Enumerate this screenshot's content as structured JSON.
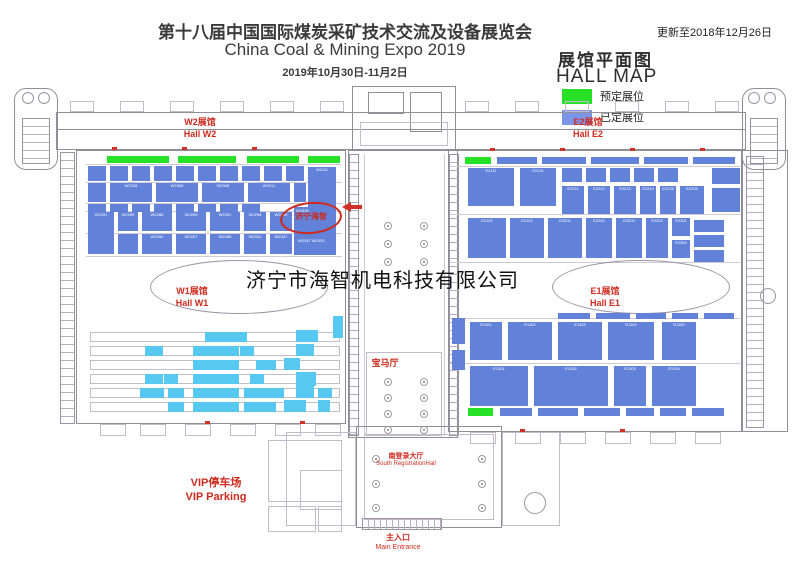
{
  "header": {
    "title_cn": "第十八届中国国际煤炭采矿技术交流及设备展览会",
    "title_en": "China Coal & Mining Expo 2019",
    "dates": "2019年10月30日-11月2日",
    "updated": "更新至2018年12月26日"
  },
  "legend": {
    "title_cn": "展馆平面图",
    "title_en": "HALL MAP",
    "items": [
      {
        "label": "预定展位",
        "color": "#27e127"
      },
      {
        "label": "已定展位",
        "color": "#7d95e8"
      }
    ]
  },
  "colors": {
    "booked": "#6282da",
    "light": "#57c9f1",
    "reserved": "#27e127"
  },
  "halls": {
    "w2": {
      "cn": "W2展馆",
      "en": "Hall W2"
    },
    "e2": {
      "cn": "E2展馆",
      "en": "Hall E2"
    },
    "w1": {
      "cn": "W1展馆",
      "en": "Hall W1"
    },
    "e1": {
      "cn": "E1展馆",
      "en": "Hall E1"
    }
  },
  "labels": {
    "bmw_hall": "宝马厅",
    "south_hall_cn": "南登录大厅",
    "south_hall_en": "South RegistrationHall",
    "vip_cn": "VIP停车场",
    "vip_en": "VIP Parking",
    "entrance_cn": "主入口",
    "entrance_en": "Main Entrance",
    "watermark": "济宁市海智机电科技有限公司"
  },
  "highlight": {
    "company": "济宁海智",
    "booth_top": "W2335",
    "booths_bottom": "W2337  W2333"
  },
  "floorplan": {
    "booths": [
      [
        107,
        156,
        62,
        7,
        "g"
      ],
      [
        178,
        156,
        58,
        7,
        "g"
      ],
      [
        247,
        156,
        52,
        7,
        "g"
      ],
      [
        308,
        156,
        32,
        7,
        "g"
      ],
      [
        465,
        157,
        26,
        7,
        "g"
      ],
      [
        468,
        408,
        25,
        8,
        "g"
      ],
      [
        497,
        157,
        40,
        7,
        "b"
      ],
      [
        542,
        157,
        44,
        7,
        "b"
      ],
      [
        591,
        157,
        48,
        7,
        "b"
      ],
      [
        644,
        157,
        44,
        7,
        "b"
      ],
      [
        693,
        157,
        42,
        7,
        "b"
      ],
      [
        558,
        313,
        32,
        6,
        "b"
      ],
      [
        596,
        313,
        34,
        6,
        "b"
      ],
      [
        636,
        313,
        30,
        6,
        "b"
      ],
      [
        672,
        313,
        26,
        6,
        "b"
      ],
      [
        704,
        313,
        30,
        6,
        "b"
      ],
      [
        500,
        408,
        32,
        8,
        "b"
      ],
      [
        538,
        408,
        40,
        8,
        "b"
      ],
      [
        584,
        408,
        36,
        8,
        "b"
      ],
      [
        626,
        408,
        28,
        8,
        "b"
      ],
      [
        660,
        408,
        26,
        8,
        "b"
      ],
      [
        692,
        408,
        32,
        8,
        "b"
      ],
      [
        88,
        166,
        18,
        15,
        "b"
      ],
      [
        110,
        166,
        18,
        15,
        "b"
      ],
      [
        132,
        166,
        18,
        15,
        "b"
      ],
      [
        154,
        166,
        18,
        15,
        "b"
      ],
      [
        176,
        166,
        18,
        15,
        "b"
      ],
      [
        198,
        166,
        18,
        15,
        "b"
      ],
      [
        220,
        166,
        18,
        15,
        "b"
      ],
      [
        242,
        166,
        18,
        15,
        "b"
      ],
      [
        264,
        166,
        18,
        15,
        "b"
      ],
      [
        286,
        166,
        18,
        15,
        "b"
      ],
      [
        308,
        167,
        28,
        42,
        "b",
        "W2111"
      ],
      [
        88,
        183,
        18,
        19,
        "b"
      ],
      [
        110,
        183,
        42,
        19,
        "b",
        "W2305"
      ],
      [
        156,
        183,
        42,
        19,
        "b",
        "W2306"
      ],
      [
        202,
        183,
        42,
        19,
        "b",
        "W2308"
      ],
      [
        248,
        183,
        42,
        19,
        "b",
        "W2311"
      ],
      [
        294,
        183,
        12,
        19,
        "b"
      ],
      [
        88,
        204,
        18,
        8,
        "b"
      ],
      [
        110,
        204,
        18,
        8,
        "b"
      ],
      [
        132,
        204,
        18,
        8,
        "b"
      ],
      [
        154,
        204,
        18,
        8,
        "b"
      ],
      [
        176,
        204,
        18,
        8,
        "b"
      ],
      [
        198,
        204,
        18,
        8,
        "b"
      ],
      [
        220,
        204,
        18,
        8,
        "b"
      ],
      [
        242,
        204,
        18,
        8,
        "b"
      ],
      [
        88,
        212,
        26,
        42,
        "b",
        "W2201"
      ],
      [
        118,
        212,
        20,
        19,
        "b",
        "W2289"
      ],
      [
        142,
        212,
        30,
        19,
        "b",
        "W2286"
      ],
      [
        176,
        212,
        30,
        19,
        "b",
        "W2283"
      ],
      [
        210,
        212,
        30,
        19,
        "b",
        "W2301"
      ],
      [
        244,
        212,
        22,
        19,
        "b",
        "W2298"
      ],
      [
        270,
        212,
        22,
        19,
        "b",
        "W2295"
      ],
      [
        294,
        207,
        42,
        48,
        "b"
      ],
      [
        118,
        234,
        20,
        20,
        "b"
      ],
      [
        142,
        234,
        30,
        20,
        "b",
        "W2284"
      ],
      [
        176,
        234,
        30,
        20,
        "b",
        "W2287"
      ],
      [
        210,
        234,
        30,
        20,
        "b",
        "W2288"
      ],
      [
        244,
        234,
        22,
        20,
        "b",
        "W2304"
      ],
      [
        270,
        234,
        22,
        20,
        "b",
        "W2307"
      ],
      [
        468,
        168,
        46,
        38,
        "b",
        "E2111"
      ],
      [
        520,
        168,
        36,
        38,
        "b",
        "E2131"
      ],
      [
        562,
        168,
        20,
        14,
        "b"
      ],
      [
        586,
        168,
        20,
        14,
        "b"
      ],
      [
        610,
        168,
        20,
        14,
        "b"
      ],
      [
        634,
        168,
        20,
        14,
        "b"
      ],
      [
        658,
        168,
        20,
        14,
        "b"
      ],
      [
        712,
        168,
        28,
        16,
        "b"
      ],
      [
        712,
        188,
        28,
        24,
        "b"
      ],
      [
        562,
        186,
        22,
        28,
        "b",
        "E2211"
      ],
      [
        588,
        186,
        22,
        28,
        "b",
        "E2212"
      ],
      [
        614,
        186,
        22,
        28,
        "b",
        "E2213"
      ],
      [
        640,
        186,
        16,
        28,
        "b",
        "E2214"
      ],
      [
        660,
        186,
        16,
        28,
        "b",
        "E2215"
      ],
      [
        680,
        186,
        24,
        28,
        "b",
        "E2209"
      ],
      [
        468,
        218,
        38,
        40,
        "b",
        "E2101"
      ],
      [
        510,
        218,
        34,
        40,
        "b",
        "E2102"
      ],
      [
        548,
        218,
        34,
        40,
        "b",
        "E2201"
      ],
      [
        586,
        218,
        26,
        40,
        "b",
        "E2202"
      ],
      [
        616,
        218,
        26,
        40,
        "b",
        "E2203"
      ],
      [
        646,
        218,
        22,
        40,
        "b",
        "E2204"
      ],
      [
        672,
        218,
        18,
        18,
        "b",
        "E2301"
      ],
      [
        672,
        240,
        18,
        18,
        "b",
        "E2302"
      ],
      [
        694,
        220,
        30,
        12,
        "b"
      ],
      [
        694,
        235,
        30,
        12,
        "b"
      ],
      [
        694,
        250,
        30,
        12,
        "b"
      ],
      [
        470,
        322,
        32,
        38,
        "b",
        "E1101"
      ],
      [
        508,
        322,
        44,
        38,
        "b",
        "E1102"
      ],
      [
        558,
        322,
        44,
        38,
        "b",
        "E1103"
      ],
      [
        608,
        322,
        46,
        38,
        "b",
        "E1104"
      ],
      [
        662,
        322,
        34,
        38,
        "b",
        "E1105"
      ],
      [
        470,
        366,
        58,
        40,
        "b",
        "E1301"
      ],
      [
        534,
        366,
        74,
        40,
        "b",
        "E1302"
      ],
      [
        614,
        366,
        32,
        40,
        "b",
        "E1303"
      ],
      [
        652,
        366,
        44,
        40,
        "b",
        "E1304"
      ],
      [
        452,
        318,
        13,
        26,
        "b"
      ],
      [
        452,
        350,
        13,
        20,
        "b"
      ],
      [
        205,
        332,
        42,
        10,
        "t"
      ],
      [
        296,
        330,
        22,
        12,
        "t"
      ],
      [
        145,
        346,
        18,
        10,
        "t"
      ],
      [
        193,
        346,
        46,
        10,
        "t"
      ],
      [
        240,
        346,
        14,
        10,
        "t"
      ],
      [
        296,
        344,
        18,
        12,
        "t"
      ],
      [
        193,
        360,
        46,
        10,
        "t"
      ],
      [
        256,
        360,
        20,
        10,
        "t"
      ],
      [
        284,
        358,
        16,
        12,
        "t"
      ],
      [
        145,
        374,
        18,
        10,
        "t"
      ],
      [
        164,
        374,
        14,
        10,
        "t"
      ],
      [
        193,
        374,
        46,
        10,
        "t"
      ],
      [
        250,
        374,
        14,
        10,
        "t"
      ],
      [
        296,
        372,
        20,
        14,
        "t"
      ],
      [
        140,
        388,
        24,
        10,
        "t"
      ],
      [
        168,
        388,
        16,
        10,
        "t"
      ],
      [
        193,
        388,
        46,
        10,
        "t"
      ],
      [
        244,
        388,
        40,
        10,
        "t"
      ],
      [
        296,
        386,
        18,
        12,
        "t"
      ],
      [
        318,
        388,
        14,
        10,
        "t"
      ],
      [
        168,
        402,
        16,
        10,
        "t"
      ],
      [
        193,
        402,
        46,
        10,
        "t"
      ],
      [
        244,
        402,
        32,
        10,
        "t"
      ],
      [
        284,
        400,
        22,
        12,
        "t"
      ],
      [
        318,
        400,
        12,
        12,
        "t"
      ],
      [
        333,
        316,
        10,
        22,
        "t"
      ]
    ],
    "structures": [
      [
        "ro",
        14,
        88,
        44,
        82
      ],
      [
        "ci",
        22,
        92,
        12,
        12
      ],
      [
        "ci",
        38,
        92,
        12,
        12
      ],
      [
        "th",
        22,
        118,
        28,
        46
      ],
      [
        "ro",
        742,
        88,
        44,
        82
      ],
      [
        "ci",
        748,
        92,
        12,
        12
      ],
      [
        "ci",
        764,
        92,
        12,
        12
      ],
      [
        "th",
        750,
        118,
        28,
        46
      ],
      [
        "o",
        56,
        112,
        690,
        38
      ],
      [
        "ln",
        56,
        129,
        690,
        1
      ],
      [
        "lo",
        70,
        101,
        24,
        11
      ],
      [
        "lo",
        120,
        101,
        24,
        11
      ],
      [
        "lo",
        170,
        101,
        24,
        11
      ],
      [
        "lo",
        220,
        101,
        24,
        11
      ],
      [
        "lo",
        270,
        101,
        24,
        11
      ],
      [
        "lo",
        320,
        101,
        24,
        11
      ],
      [
        "lo",
        465,
        101,
        24,
        11
      ],
      [
        "lo",
        515,
        101,
        24,
        11
      ],
      [
        "lo",
        565,
        101,
        24,
        11
      ],
      [
        "lo",
        615,
        101,
        24,
        11
      ],
      [
        "lo",
        665,
        101,
        24,
        11
      ],
      [
        "lo",
        715,
        101,
        24,
        11
      ],
      [
        "o",
        352,
        86,
        104,
        64
      ],
      [
        "o",
        368,
        92,
        36,
        22
      ],
      [
        "o",
        410,
        92,
        32,
        40
      ],
      [
        "lo",
        360,
        122,
        88,
        24
      ],
      [
        "o",
        76,
        150,
        270,
        274
      ],
      [
        "o",
        448,
        150,
        294,
        282
      ],
      [
        "th",
        60,
        152,
        15,
        272
      ],
      [
        "o",
        742,
        150,
        46,
        282
      ],
      [
        "th",
        746,
        156,
        18,
        272
      ],
      [
        "ci",
        760,
        288,
        16,
        16
      ],
      [
        "o",
        348,
        150,
        110,
        288
      ],
      [
        "th",
        349,
        154,
        10,
        282
      ],
      [
        "th",
        449,
        154,
        10,
        282
      ],
      [
        "lnl",
        364,
        154,
        1,
        282
      ],
      [
        "lnl",
        444,
        154,
        1,
        282
      ],
      [
        "lnl",
        86,
        164,
        256,
        1
      ],
      [
        "lnl",
        86,
        182,
        256,
        1
      ],
      [
        "lnl",
        86,
        203,
        256,
        1
      ],
      [
        "lnl",
        86,
        211,
        256,
        1
      ],
      [
        "lnl",
        86,
        233,
        256,
        1
      ],
      [
        "lnl",
        86,
        256,
        256,
        1
      ],
      [
        "lnl",
        450,
        166,
        290,
        1
      ],
      [
        "lnl",
        450,
        214,
        290,
        1
      ],
      [
        "lnl",
        450,
        262,
        290,
        1
      ],
      [
        "lnl",
        450,
        318,
        290,
        1
      ],
      [
        "lnl",
        450,
        363,
        290,
        1
      ],
      [
        "ci",
        150,
        260,
        178,
        54
      ],
      [
        "ci",
        552,
        260,
        178,
        54
      ],
      [
        "lo",
        90,
        332,
        250,
        10
      ],
      [
        "lo",
        90,
        346,
        250,
        10
      ],
      [
        "lo",
        90,
        360,
        250,
        10
      ],
      [
        "lo",
        90,
        374,
        250,
        10
      ],
      [
        "lo",
        90,
        388,
        250,
        10
      ],
      [
        "lo",
        90,
        402,
        250,
        10
      ],
      [
        "lo",
        366,
        352,
        76,
        84
      ],
      [
        "o",
        356,
        426,
        146,
        102
      ],
      [
        "lo",
        364,
        434,
        130,
        86
      ],
      [
        "lo",
        286,
        432,
        70,
        94
      ],
      [
        "lo",
        300,
        470,
        42,
        40
      ],
      [
        "lo",
        502,
        432,
        58,
        94
      ],
      [
        "ci",
        524,
        492,
        22,
        22
      ],
      [
        "tv",
        362,
        518,
        80,
        12
      ],
      [
        "lo",
        268,
        440,
        74,
        62
      ],
      [
        "lo",
        268,
        506,
        48,
        26
      ],
      [
        "lo",
        318,
        506,
        24,
        26
      ],
      [
        "lo",
        100,
        424,
        26,
        12
      ],
      [
        "lo",
        140,
        424,
        26,
        12
      ],
      [
        "lo",
        185,
        424,
        26,
        12
      ],
      [
        "lo",
        230,
        424,
        26,
        12
      ],
      [
        "lo",
        275,
        424,
        26,
        12
      ],
      [
        "lo",
        315,
        424,
        26,
        12
      ],
      [
        "lo",
        470,
        432,
        26,
        12
      ],
      [
        "lo",
        515,
        432,
        26,
        12
      ],
      [
        "lo",
        560,
        432,
        26,
        12
      ],
      [
        "lo",
        605,
        432,
        26,
        12
      ],
      [
        "lo",
        650,
        432,
        26,
        12
      ],
      [
        "lo",
        695,
        432,
        26,
        12
      ],
      [
        "rd",
        112,
        147,
        5,
        3
      ],
      [
        "rd",
        182,
        147,
        5,
        3
      ],
      [
        "rd",
        252,
        147,
        5,
        3
      ],
      [
        "rd",
        490,
        148,
        5,
        3
      ],
      [
        "rd",
        560,
        148,
        5,
        3
      ],
      [
        "rd",
        630,
        148,
        5,
        3
      ],
      [
        "rd",
        700,
        148,
        5,
        3
      ],
      [
        "rd",
        205,
        421,
        5,
        3
      ],
      [
        "rd",
        300,
        421,
        5,
        3
      ],
      [
        "rd",
        520,
        429,
        5,
        3
      ],
      [
        "rd",
        620,
        429,
        5,
        3
      ]
    ],
    "dots": [
      [
        384,
        222
      ],
      [
        420,
        222
      ],
      [
        384,
        240
      ],
      [
        420,
        240
      ],
      [
        384,
        258
      ],
      [
        420,
        258
      ],
      [
        384,
        378
      ],
      [
        420,
        378
      ],
      [
        384,
        394
      ],
      [
        420,
        394
      ],
      [
        384,
        410
      ],
      [
        420,
        410
      ],
      [
        384,
        426
      ],
      [
        420,
        426
      ],
      [
        372,
        455
      ],
      [
        478,
        455
      ],
      [
        372,
        480
      ],
      [
        478,
        480
      ],
      [
        372,
        504
      ],
      [
        478,
        504
      ]
    ]
  }
}
